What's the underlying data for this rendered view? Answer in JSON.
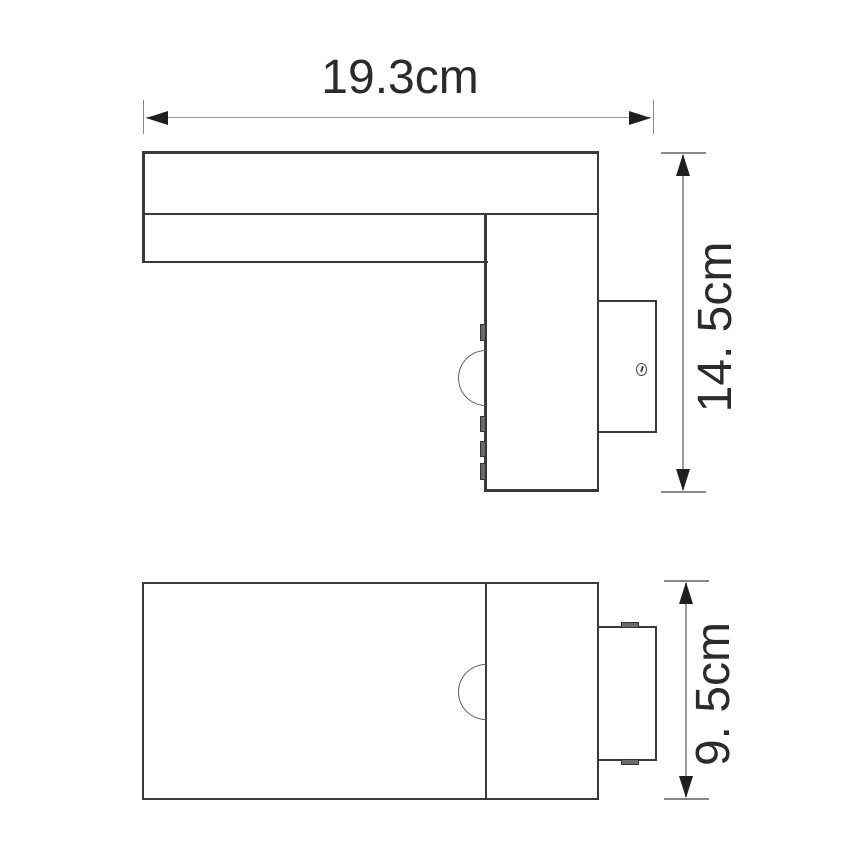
{
  "diagram": {
    "type": "product-dimension-drawing",
    "subject": "outdoor wall light with motion sensor, two orthographic views",
    "views": {
      "side_view": "L-shaped side profile with sensor dome, mounting tabs and wall bracket with screw",
      "front_view": "rectangular front/bottom profile with sensor dome and wall bracket with clips"
    },
    "dimensions": {
      "width": {
        "label": "19.3cm",
        "value_cm": 19.3,
        "orientation": "horizontal"
      },
      "height": {
        "label": "14. 5cm",
        "value_cm": 14.5,
        "orientation": "vertical"
      },
      "depth": {
        "label": "9. 5cm",
        "value_cm": 9.5,
        "orientation": "vertical"
      }
    },
    "colors": {
      "background": "#ffffff",
      "outline": "#3a3a3a",
      "dimension_line": "#9a9a9a",
      "arrowhead": "#1f1f1f",
      "label_text": "#2b2b2b"
    }
  }
}
